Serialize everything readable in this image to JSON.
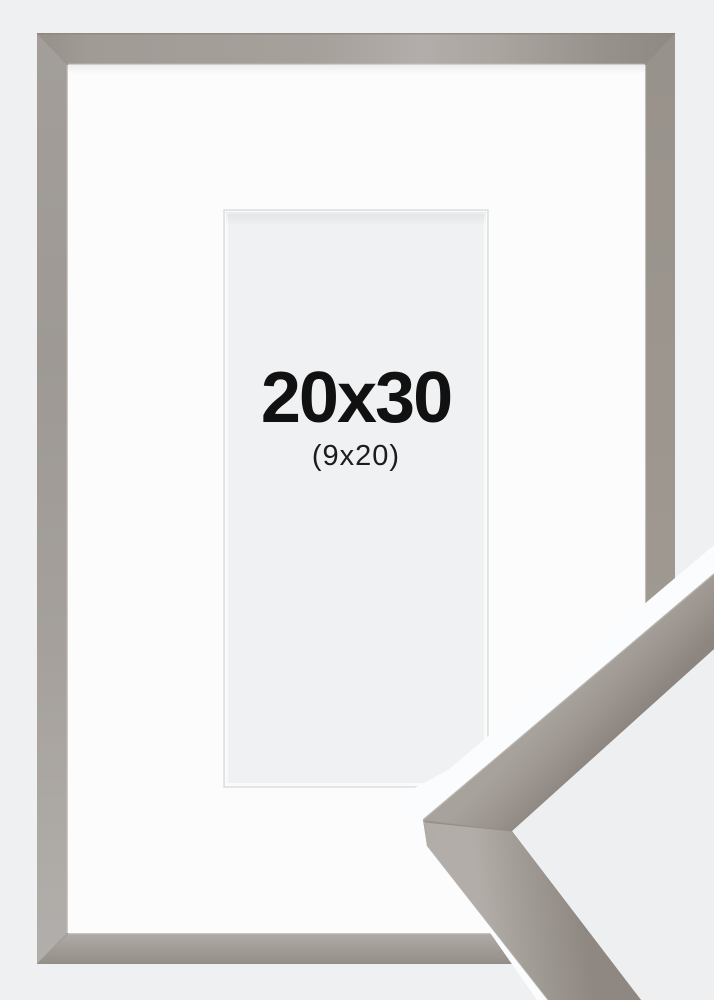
{
  "product_image": {
    "size_label": "20x30",
    "picture_opening_label": "(9x20)"
  },
  "colors": {
    "page_bg": "#eef0f2",
    "mat_white": "#fcfcfd",
    "opening_fill": "#f0f1f2",
    "label_text": "#111111",
    "frame_taupe": "#a29c96",
    "frame_taupe_light": "#b3aeaa",
    "frame_taupe_dark": "#8d8680"
  }
}
